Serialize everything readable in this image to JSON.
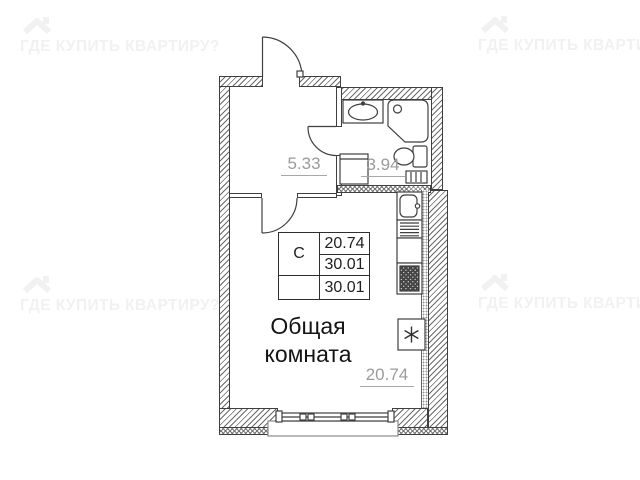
{
  "watermark": {
    "text": "ГДЕ КУПИТЬ КВАРТИРУ?",
    "color": "#f1f1f1",
    "icon": "house-roof-icon"
  },
  "plan": {
    "labels": {
      "hallway_area": "5.33",
      "bathroom_area": "3.94",
      "room_area": "20.74",
      "room_name": "Общая комната"
    },
    "info_table": {
      "type": "С",
      "values": [
        "20.74",
        "30.01",
        "30.01"
      ]
    },
    "symbols": {
      "refrigerator_star": "✳"
    },
    "colors": {
      "line": "#3f3f3f",
      "area_label": "#9b9b9b",
      "text": "#1f1f1f",
      "watermark": "#f1f1f1"
    }
  }
}
